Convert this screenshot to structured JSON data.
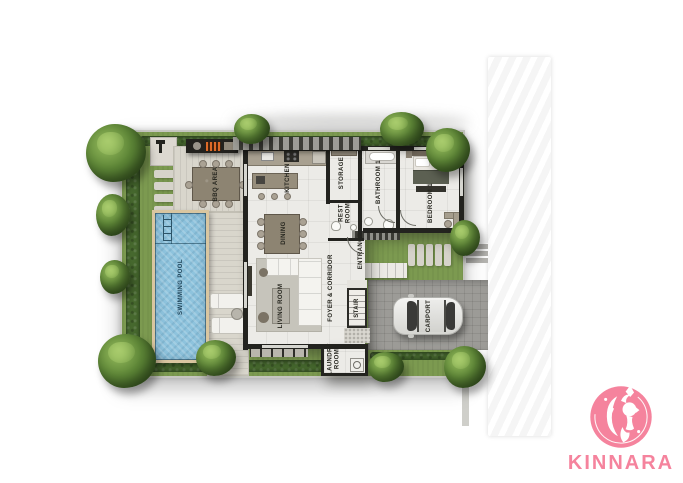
{
  "brand": {
    "name": "KINNARA"
  },
  "floorplan": {
    "labels": {
      "swimming_pool": "SWIMMING POOL",
      "bbq_area": "BBQ AREA",
      "kitchen": "KITCHEN",
      "dining": "DINING",
      "storage": "STORAGE",
      "rest_room": "REST ROOM",
      "bathroom_1": "BATHROOM 1",
      "bedroom_1": "BEDROOM 1",
      "entrance": "ENTRANCE",
      "foyer_corridor": "FOYER & CORRIDOR",
      "living_room": "LIVING ROOM",
      "stair": "STAIR",
      "laundry_room": "LAUNDRY ROOM",
      "carport": "CARPORT"
    },
    "colors": {
      "brand_pink": "#f5839d",
      "grass": "#7c9a50",
      "hedge": "#46682e",
      "pool_water": "#8ec3dd",
      "pool_edge": "#d9c6a0",
      "deck": "#d9d6cc",
      "floor_tile": "#ecebe7",
      "wall": "#23231f",
      "road": "#a9a8a4"
    }
  }
}
